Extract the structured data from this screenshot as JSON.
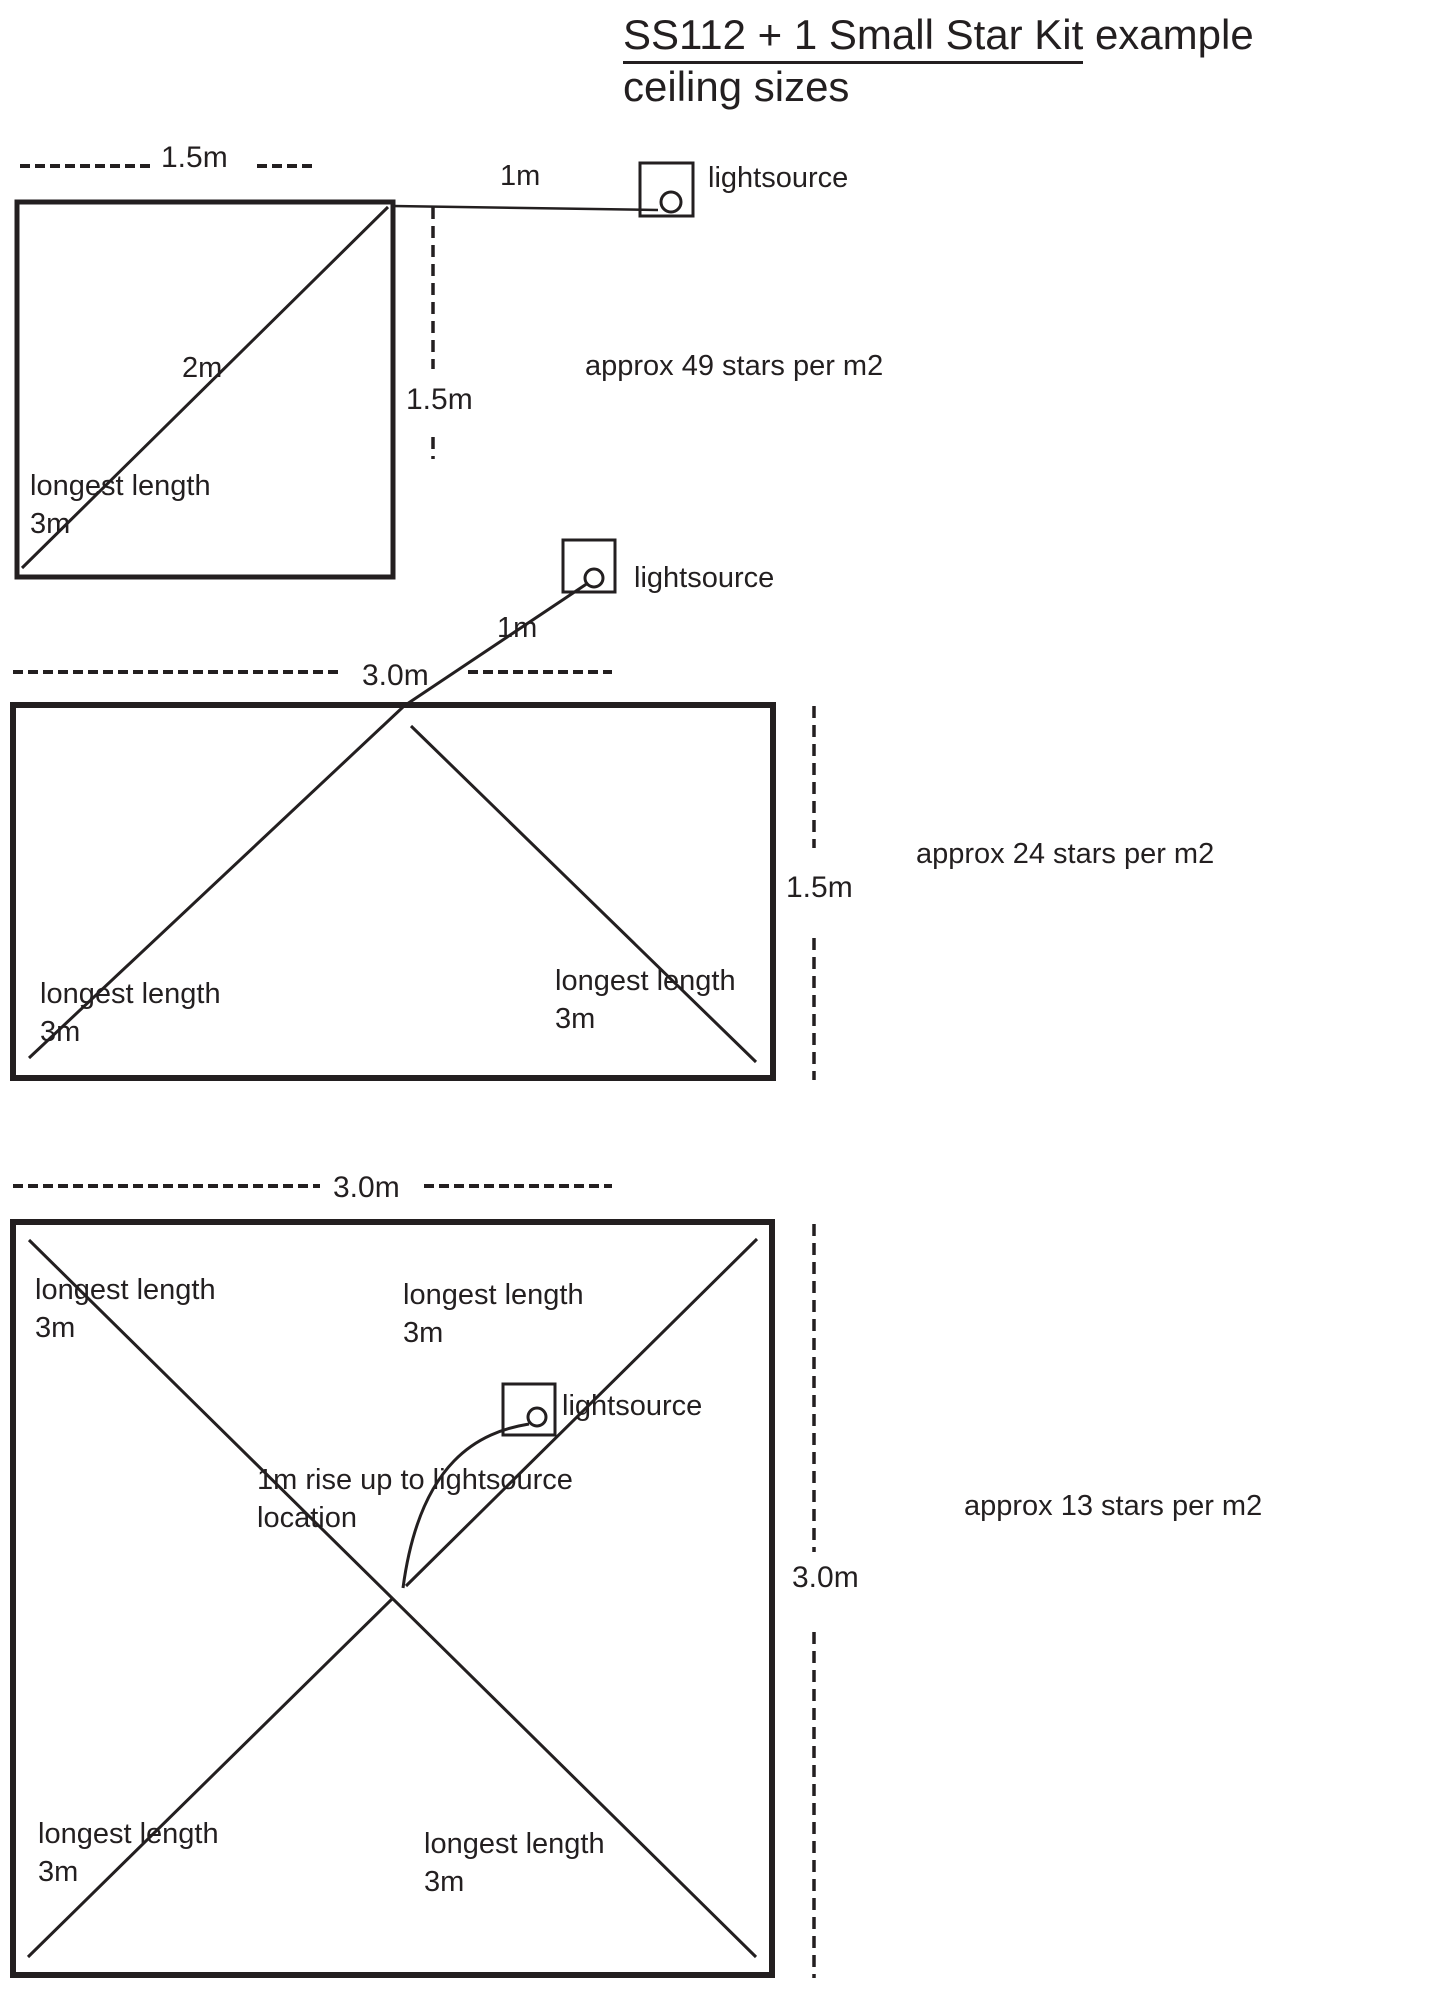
{
  "colors": {
    "ink": "#231f20",
    "background": "#ffffff"
  },
  "title": {
    "underlined": "SS112 + 1 Small Star Kit",
    "rest": " example",
    "line2": "ceiling sizes"
  },
  "diagram1": {
    "width_label": "1.5m",
    "height_label": "1.5m",
    "diagonal_label": "2m",
    "longest_length_label": "longest length\n3m",
    "lightsource_distance_label": "1m",
    "lightsource_label": "lightsource",
    "density_label": "approx 49 stars per m2"
  },
  "diagram2": {
    "width_label": "3.0m",
    "height_label": "1.5m",
    "lightsource_distance_label": "1m",
    "lightsource_label": "lightsource",
    "left_longest_length_label": "longest length\n3m",
    "right_longest_length_label": "longest length\n3m",
    "density_label": "approx 24 stars per m2"
  },
  "diagram3": {
    "width_label": "3.0m",
    "height_label": "3.0m",
    "lightsource_label": "lightsource",
    "rise_label": "1m rise up to lightsource\nlocation",
    "top_left_longest_length_label": "longest length\n3m",
    "top_right_longest_length_label": "longest length\n3m",
    "bottom_left_longest_length_label": "longest length\n3m",
    "bottom_right_longest_length_label": "longest length\n3m",
    "density_label": "approx 13 stars per m2"
  }
}
